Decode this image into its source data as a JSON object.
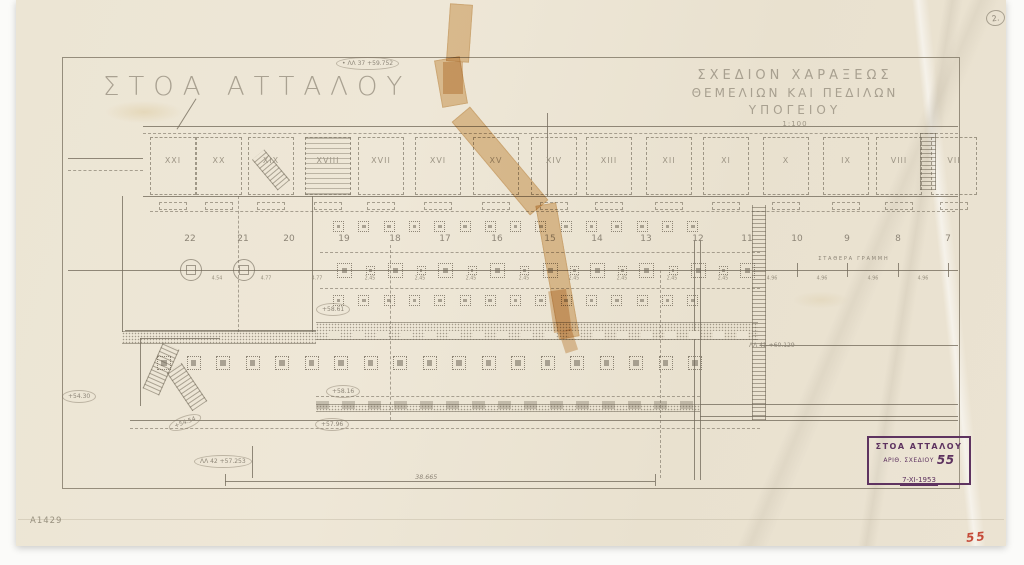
{
  "sheet": {
    "paper_corner_number": "2.",
    "catalog_number": "A1429",
    "red_drawing_number": "55"
  },
  "titles": {
    "main_title": "ΣΤΟΑ ΑΤΤΑΛΟΥ",
    "drawing_title_line1": "ΣΧΕΔΙΟΝ ΧΑΡΑΞΕΩΣ",
    "drawing_title_line2": "ΘΕΜΕΛΙΩΝ ΚΑΙ ΠΕΔΙΛΩΝ",
    "drawing_title_line3": "ΥΠΟΓΕΙΟΥ",
    "scale": "1:100"
  },
  "stamp": {
    "title": "ΣΤΟΑ ΑΤΤΑΛΟΥ",
    "number_label": "ΑΡΙΘ. ΣΧΕΔΙΟΥ",
    "number_value": "55",
    "date": "7-XI-1953"
  },
  "plan": {
    "room_labels": [
      "XXI",
      "XX",
      "XIX",
      "XVIII",
      "XVII",
      "XVI",
      "XV",
      "XIV",
      "XIII",
      "XII",
      "XI",
      "X",
      "IX",
      "VIII",
      "VII"
    ],
    "axis_numbers": [
      "22",
      "21",
      "20",
      "19",
      "18",
      "17",
      "16",
      "15",
      "14",
      "13",
      "12",
      "11",
      "10",
      "9",
      "8",
      "7"
    ],
    "axis_line_label": "ΣΤΑΘΕΡΑ ΓΡΑΜΜΗ",
    "bay_dimensions": [
      "4.54",
      "4.77",
      "4.77",
      "2.45",
      "2.45",
      "2.45",
      "2.45",
      "2.45",
      "2.45",
      "2.45",
      "2.45",
      "4.96",
      "4.96",
      "4.96",
      "4.96"
    ],
    "overall_dimension": "38.665",
    "benchmarks": [
      {
        "station": "ΛΛ 37",
        "elevation": "+59.752"
      },
      {
        "station": "ΛΛ 41",
        "elevation": "+60.129"
      },
      {
        "station": "ΛΛ 42",
        "elevation": "+57.253"
      }
    ],
    "spot_elevations": [
      "+58.61",
      "+58.16",
      "+57.96",
      "+54.30",
      "+54.54"
    ]
  }
}
